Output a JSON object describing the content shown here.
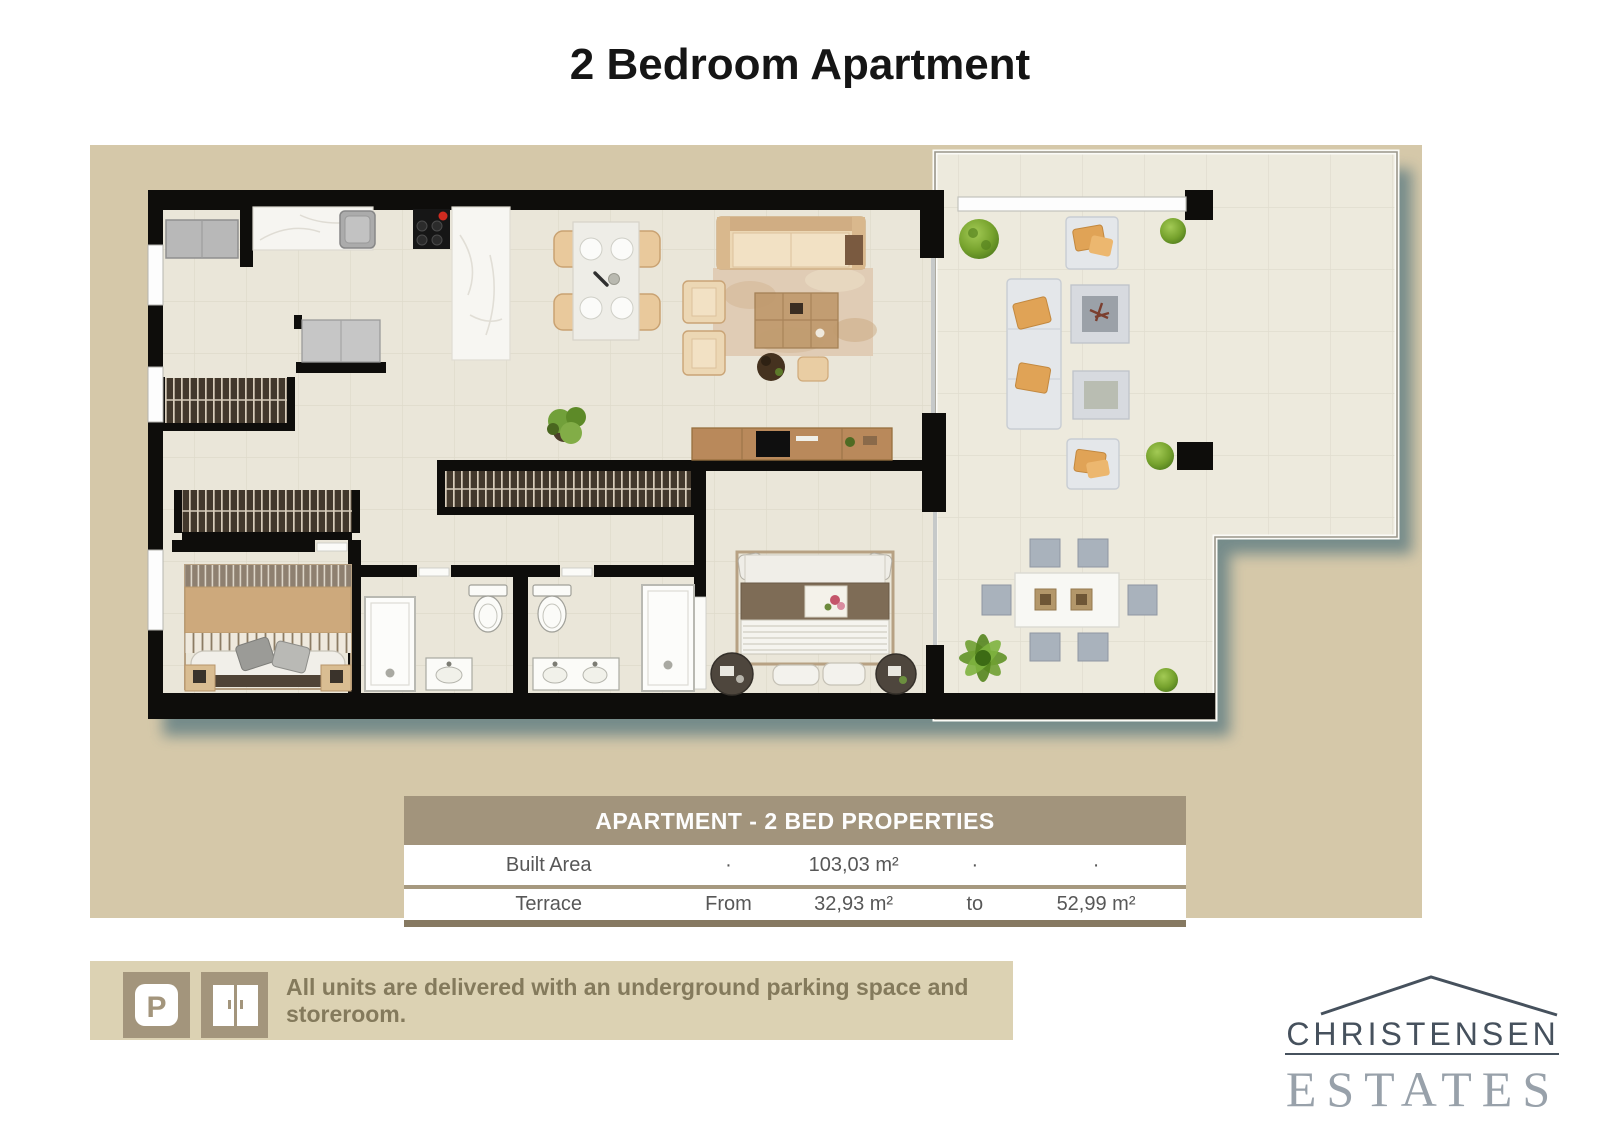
{
  "page": {
    "title": "2 Bedroom Apartment"
  },
  "table": {
    "header": "APARTMENT - 2 BED PROPERTIES",
    "rows": [
      {
        "cells": [
          "Built Area",
          "·",
          "103,03 m²",
          "·",
          "·"
        ]
      },
      {
        "cells": [
          "Terrace",
          "From",
          "32,93 m²",
          "to",
          "52,99 m²"
        ]
      }
    ]
  },
  "info_bar": {
    "text": "All units are delivered with an underground parking space and storeroom.",
    "parking_letter": "P",
    "icons": [
      "parking-icon",
      "storeroom-door-icon"
    ]
  },
  "logo": {
    "line1": "CHRISTENSEN",
    "line2": "ESTATES"
  },
  "colors": {
    "panel": "#d5c8a9",
    "wall": "#0e0d0b",
    "floor": "#eae6d9",
    "terrace_floor": "#edeadd",
    "shadow": "#6c8587",
    "table_header_bg": "#a2947c",
    "bar_bg": "#dcd2b3",
    "icon_bg": "#a3957c",
    "bar_text": "#847a5c",
    "logo_dark": "#46515d",
    "logo_light": "#98a1aa",
    "accent_red": "#cf2b20",
    "greenery": "#76a22d",
    "wood": "#b9895b"
  }
}
